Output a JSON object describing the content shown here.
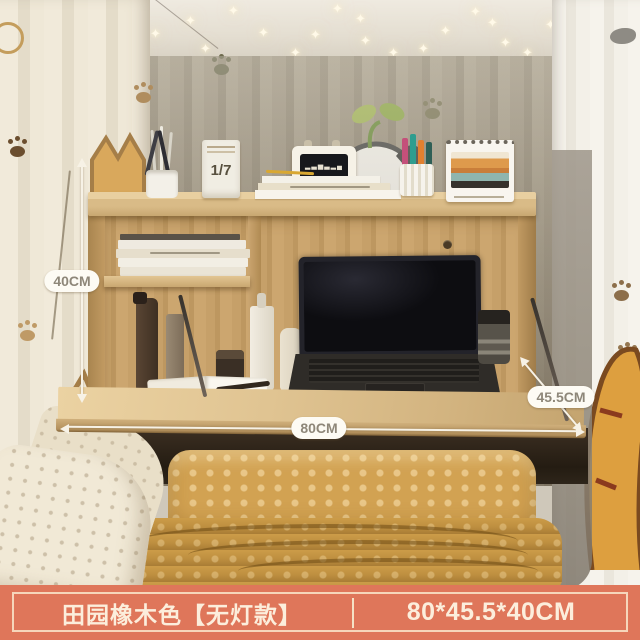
{
  "annotations": {
    "height_label": "40CM",
    "width_label": "80CM",
    "depth_label": "45.5CM"
  },
  "desk_items": {
    "flip_calendar_date": "1/7",
    "radio_waveform": "▂▃▅▃▂▄"
  },
  "banner": {
    "variant_name": "田园橡木色【无灯款】",
    "size_text": "80*45.5*40CM",
    "background_color": "#DF765A",
    "text_color": "#FCEEDC",
    "divider_color": "#F5E2C6"
  },
  "icons": {
    "string_light": "✦"
  },
  "colors": {
    "wood": "#C9A470",
    "wood_light": "#E0C492",
    "curtain_back": "#C6BFB1",
    "curtain_left": "#EFE8D7",
    "curtain_right": "#F3F0E8",
    "bedding_yellow": "#D2A252",
    "blanket_mustard": "#BE8F40",
    "laptop_black": "#0D0D11",
    "dimension_pill_bg": "#FDFBF4",
    "dimension_pill_text": "#8E8779"
  }
}
